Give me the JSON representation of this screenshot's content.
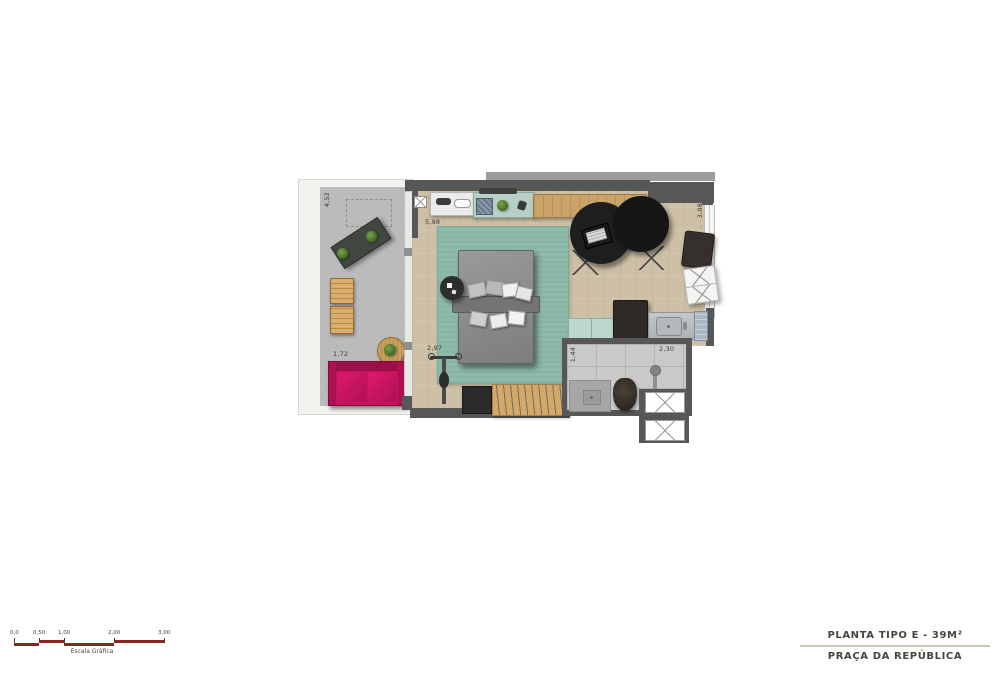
{
  "title_block": {
    "title": "PLANTA TIPO E - 39M²",
    "subtitle": "PRAÇA DA REPÚBLICA"
  },
  "scale_bar": {
    "labels": [
      "0,0",
      "0,50",
      "1,00",
      "2,00",
      "3,00"
    ],
    "caption": "Escala Gráfica"
  },
  "dimensions": {
    "balcony_length": "4,52",
    "sofa_width": "1,72",
    "living_width": "5,98",
    "closet_width": "2,97",
    "bathroom_depth": "1,44",
    "bathroom_width": "2,30",
    "living_depth": "3,08"
  },
  "colors": {
    "wall": "#575757",
    "slab": "#9c9c9c",
    "wood_floor": "#cec0a6",
    "counter_wood": "#c9a36a",
    "rug": "#8dbaa9",
    "balcony_floor": "#b9b9b9",
    "sofa": "#c6135c",
    "kitchen_teal": "#b7cfc4",
    "sideboard_mint": "#bdd8cc",
    "tile": "#c9c9c9",
    "dark_furniture": "#232323",
    "scale_red": "#8b2420",
    "title_text": "#4a453c"
  }
}
